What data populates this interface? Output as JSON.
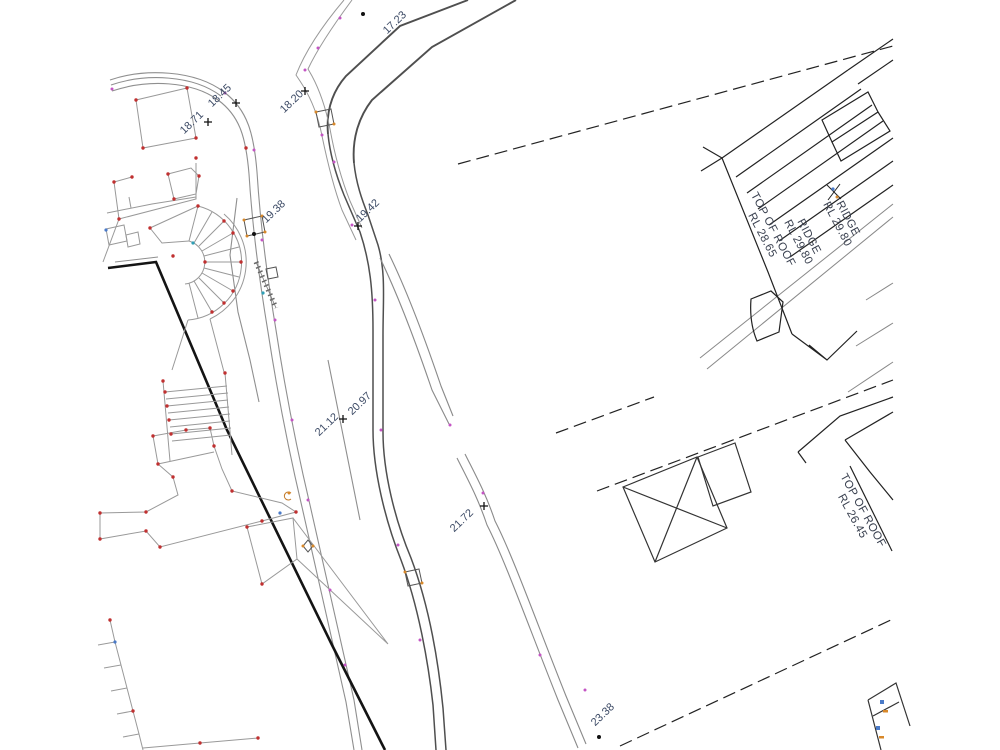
{
  "drawing": {
    "title": "site-detail-survey-plan",
    "spot_levels": [
      {
        "label": "17.23",
        "x": 397,
        "y": 25,
        "rot": -44,
        "marker": "dot",
        "mx": 363,
        "my": 14
      },
      {
        "label": "18.20",
        "x": 294,
        "y": 104,
        "rot": -44,
        "marker": "plus",
        "mx": 305,
        "my": 91
      },
      {
        "label": "18.45",
        "x": 222,
        "y": 98,
        "rot": -44,
        "marker": "plus",
        "mx": 236,
        "my": 103
      },
      {
        "label": "18.71",
        "x": 194,
        "y": 125,
        "rot": -44,
        "marker": "plus",
        "mx": 208,
        "my": 122
      },
      {
        "label": "19.38",
        "x": 276,
        "y": 214,
        "rot": -44,
        "marker": "dot",
        "mx": 254,
        "my": 234
      },
      {
        "label": "19.42",
        "x": 370,
        "y": 213,
        "rot": -44,
        "marker": "plus",
        "mx": 358,
        "my": 226
      },
      {
        "label": "20.97",
        "x": 362,
        "y": 406,
        "rot": -44,
        "marker": "none",
        "mx": 0,
        "my": 0
      },
      {
        "label": "21.12",
        "x": 329,
        "y": 427,
        "rot": -44,
        "marker": "plus",
        "mx": 343,
        "my": 419
      },
      {
        "label": "21.72",
        "x": 464,
        "y": 523,
        "rot": -44,
        "marker": "plus",
        "mx": 484,
        "my": 506
      },
      {
        "label": "23.38",
        "x": 605,
        "y": 717,
        "rot": -44,
        "marker": "dot",
        "mx": 599,
        "my": 737
      }
    ],
    "roof_labels": [
      {
        "line1": "RIDGE",
        "line2": "RL 29.80",
        "x": 845,
        "y": 220,
        "rot": 62
      },
      {
        "line1": "RIDGE",
        "line2": "RL 29.80",
        "x": 806,
        "y": 238,
        "rot": 62
      },
      {
        "line1": "TOP OF ROOF",
        "line2": "RL 28.65",
        "x": 770,
        "y": 231,
        "rot": 62
      },
      {
        "line1": "TOP OF ROOF",
        "line2": "RL 26.45",
        "x": 860,
        "y": 512,
        "rot": 61
      }
    ],
    "colors": {
      "spot_label": "#3d4b66",
      "roof_label": "#3a4150",
      "marker_black": "#111111",
      "boundary": "#141414",
      "building_line": "#222222",
      "site_line": "#8f8f8f",
      "kerb_line": "#4f4f4f",
      "vertex_red": "#c03030",
      "vertex_magenta": "#c455c4",
      "pit_orange": "#d8882a",
      "node_blue": "#4a7ac8",
      "node_teal": "#2f9fb5"
    }
  }
}
